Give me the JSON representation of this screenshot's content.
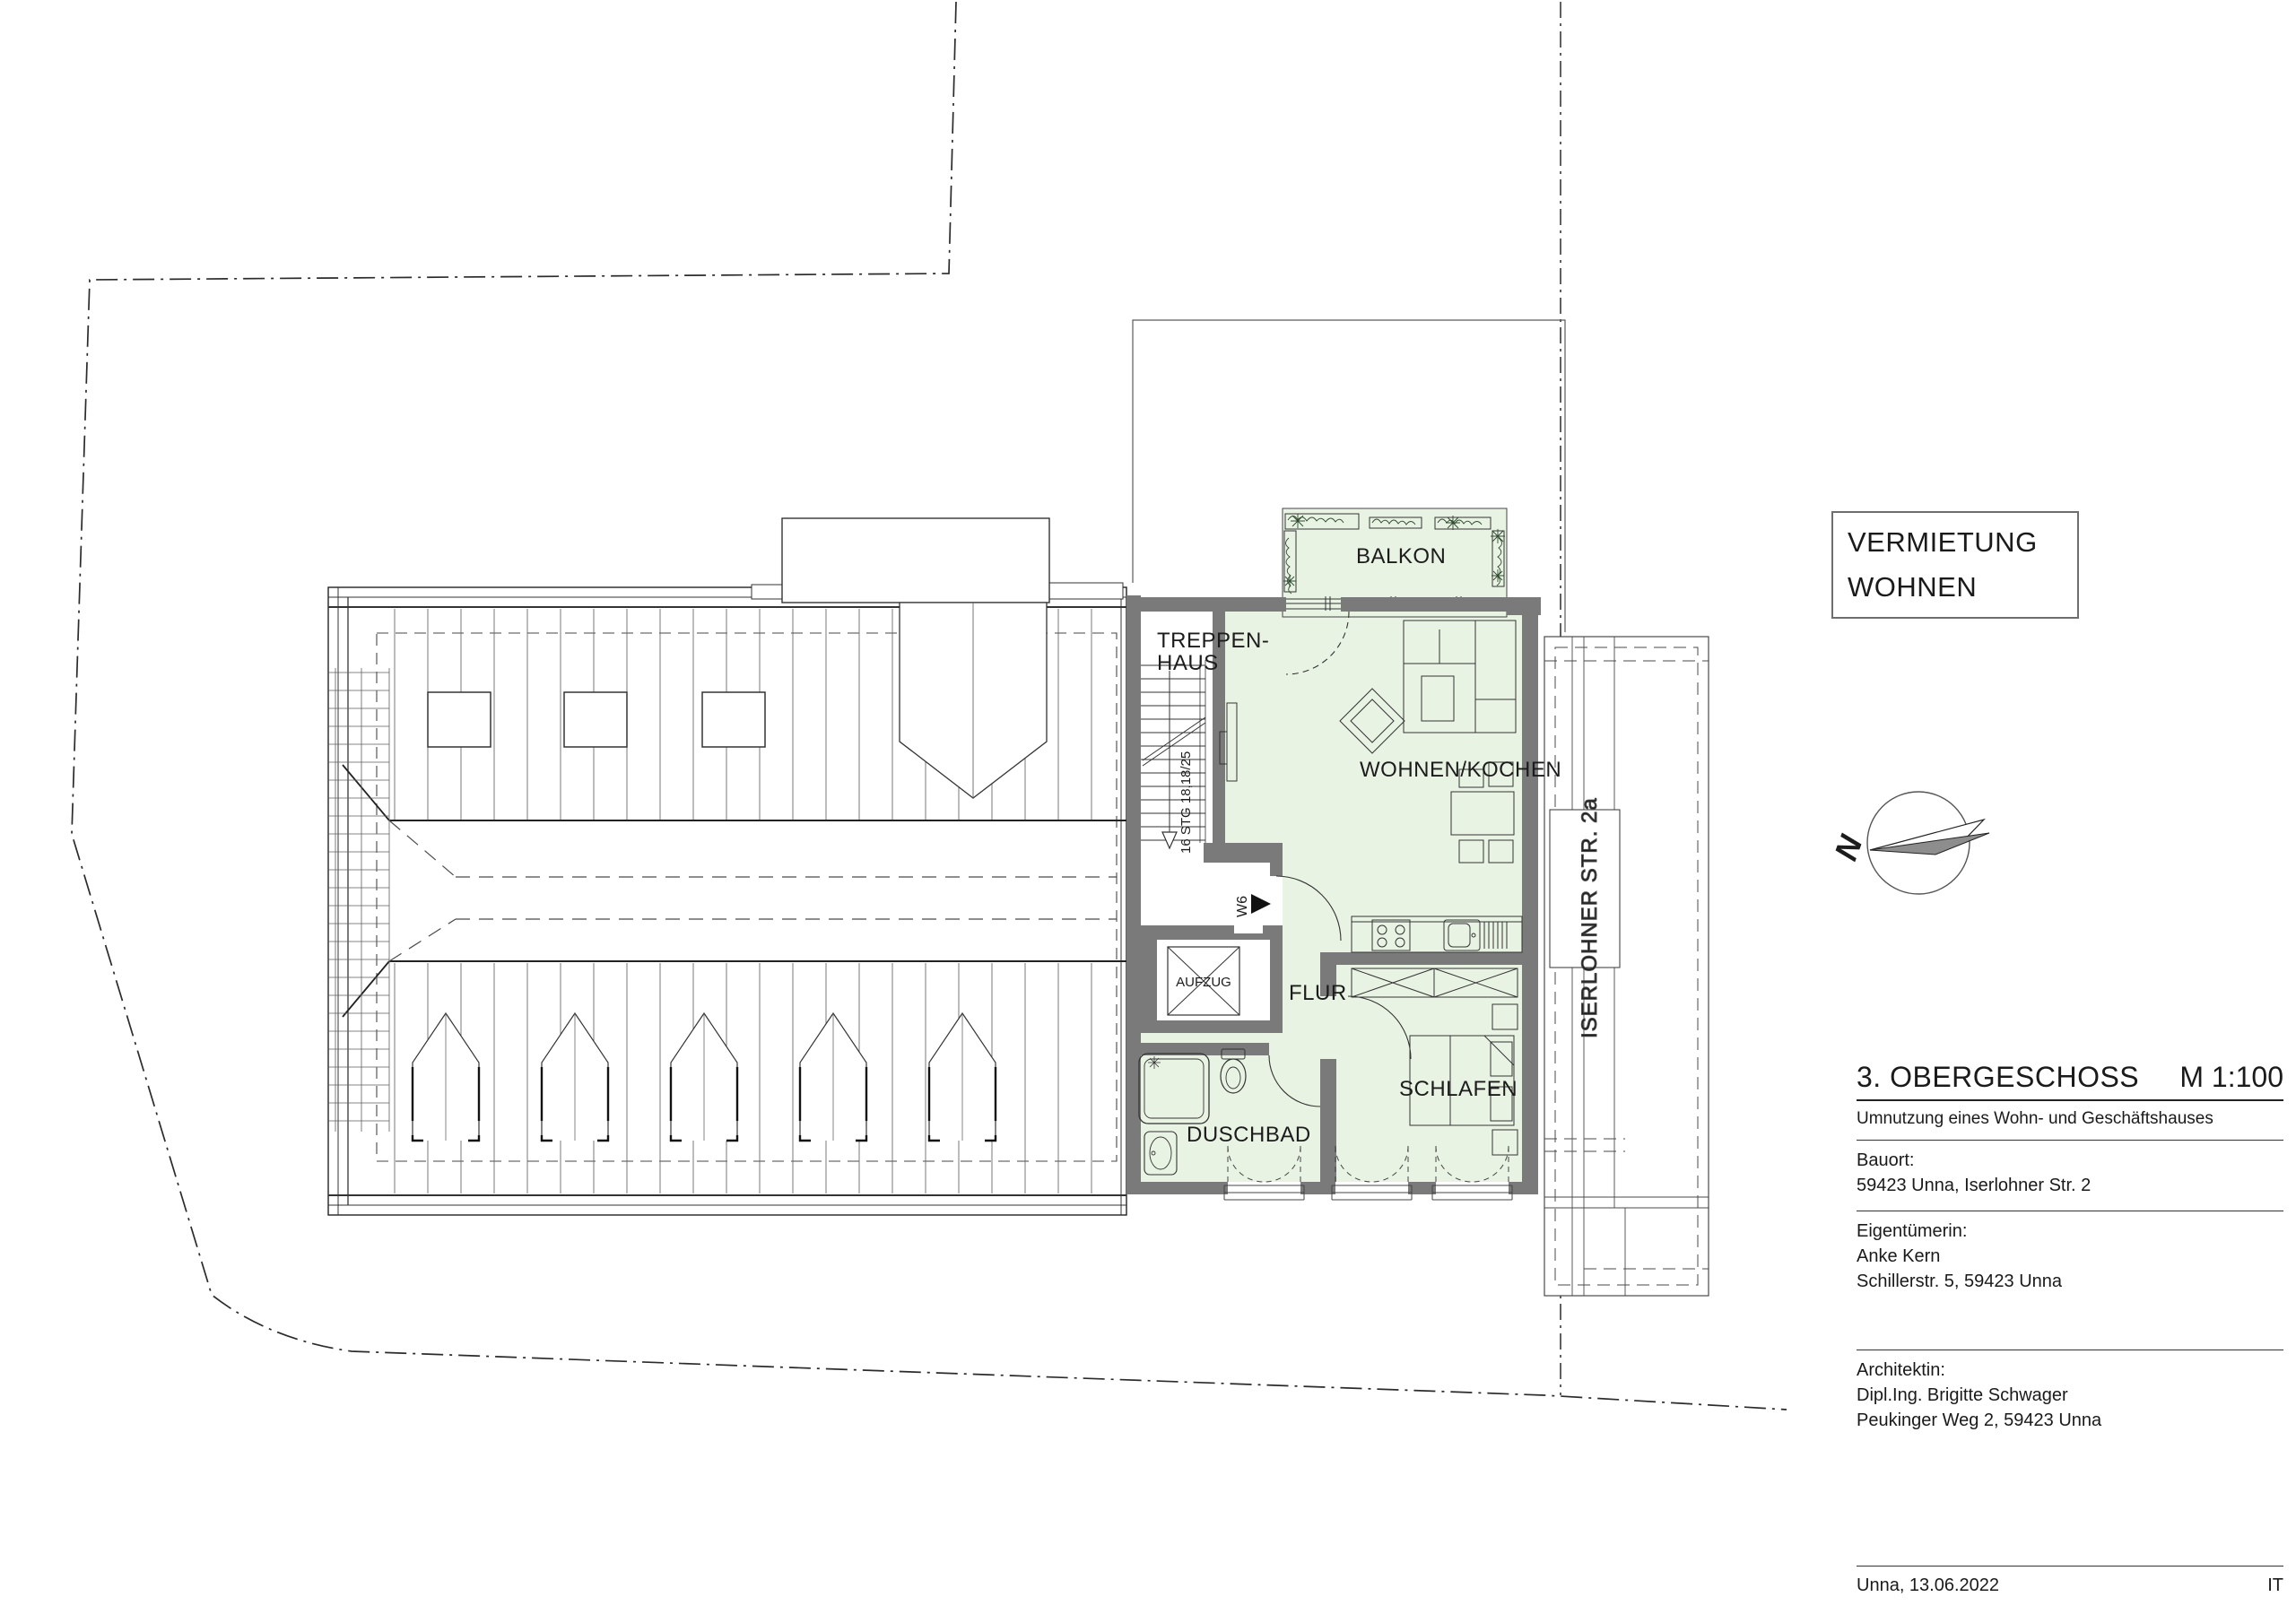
{
  "plan": {
    "rooms": {
      "balkon": "BALKON",
      "treppenhaus_line1": "TREPPEN-",
      "treppenhaus_line2": "HAUS",
      "wohnen_kochen": "WOHNEN/KOCHEN",
      "flur": "FLUR",
      "schlafen": "SCHLAFEN",
      "duschbad": "DUSCHBAD",
      "aufzug": "AUFZUG"
    },
    "annotations": {
      "stair_note": "16 STG 18,18/25",
      "entry_marker": "W6",
      "street": "ISERLOHNER STR. 2a",
      "north_letter": "N"
    }
  },
  "info_box": {
    "line1": "VERMIETUNG",
    "line2": "WOHNEN"
  },
  "title_block": {
    "title": "3. OBERGESCHOSS",
    "scale": "M 1:100",
    "subtitle": "Umnutzung eines Wohn- und Geschäftshauses",
    "bauort_label": "Bauort:",
    "bauort_value": "59423 Unna, Iserlohner Str. 2",
    "owner_label": "Eigentümerin:",
    "owner_name": "Anke Kern",
    "owner_address": "Schillerstr. 5, 59423 Unna",
    "architect_label": "Architektin:",
    "architect_name": "Dipl.Ing. Brigitte Schwager",
    "architect_address": "Peukinger Weg 2, 59423 Unna",
    "footer_left": "Unna, 13.06.2022",
    "footer_right": "IT"
  },
  "colors": {
    "room_green": "#e9f3e4",
    "wall_gray": "#7a7a7a",
    "line_dark": "#1f1f1f"
  }
}
